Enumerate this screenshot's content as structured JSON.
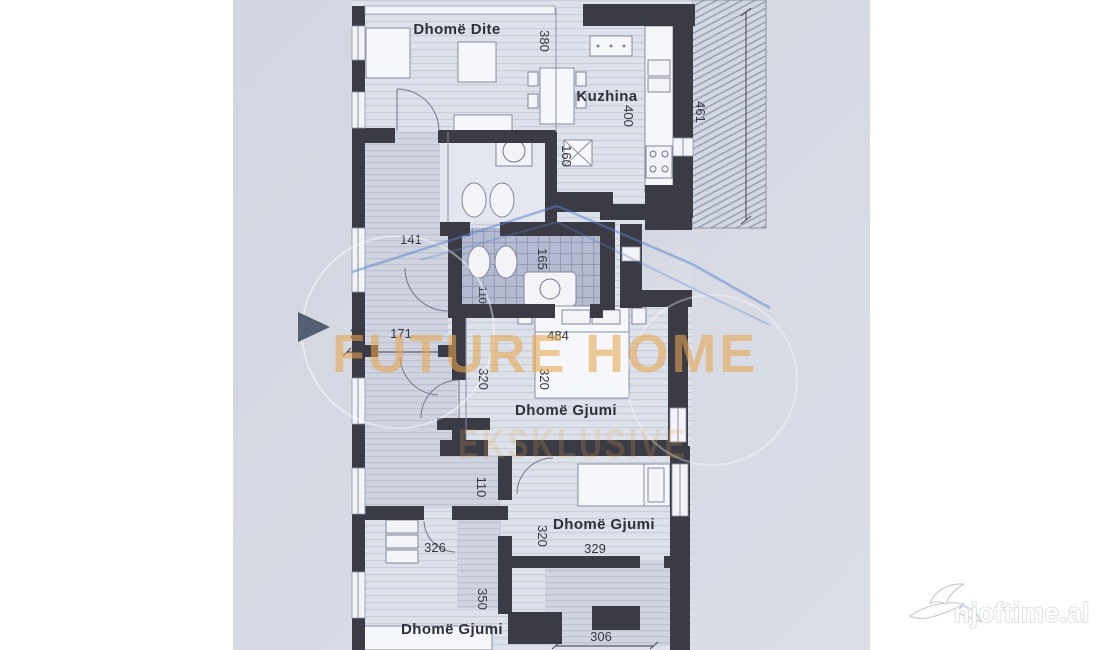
{
  "floorplan": {
    "rooms": {
      "living": "Dhomë Dite",
      "kitchen": "Kuzhina",
      "bedroom_mid": "Dhomë Gjumi",
      "bedroom_right": "Dhomë Gjumi",
      "bedroom_bottom": "Dhomë Gjumi"
    },
    "dimensions": {
      "living_width": "380",
      "kitchen_width": "400",
      "balcony_length": "461",
      "bath_width": "160",
      "hall_length": "141",
      "shower_length": "165",
      "wc_width": "110",
      "entry_step": "25",
      "entry_width": "171",
      "bedroom_mid_width": "484",
      "bedroom_mid_length_left": "320",
      "bedroom_mid_length_right": "320",
      "corridor_width": "110",
      "bedroom_bottom_width": "326",
      "bedroom_right_length": "320",
      "bedroom_right_width": "329",
      "bedroom_bottom_length": "350",
      "terrace_width": "306"
    }
  },
  "watermark": {
    "brand": "FUTURE HOME",
    "brand_sub": "EKSKLUSIVE",
    "site": "njoftime.al"
  },
  "colors": {
    "page_bg": "#ffffff",
    "photo_bg": "#d3d7e1",
    "wall": "#3a3b45",
    "brand_orange": "#e8a750",
    "swoosh_blue": "#5a82c8"
  }
}
